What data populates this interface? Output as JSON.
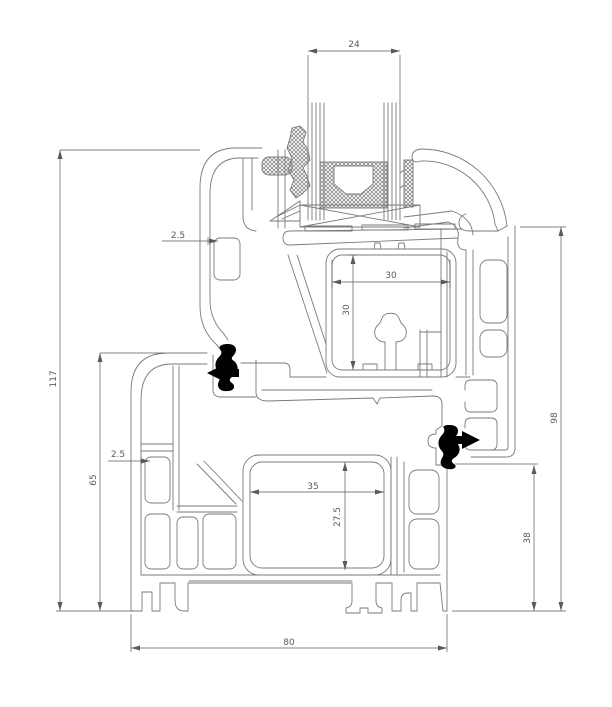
{
  "drawing": {
    "colors": {
      "line": "#7a7a7a",
      "dimension_text": "#5a5a5a",
      "seal": "#000000",
      "background": "#ffffff",
      "hatch": "#8a8a8a"
    },
    "dimensions": [
      {
        "name": "glazing-unit-width",
        "value": "24"
      },
      {
        "name": "sash-wall-thickness",
        "value": "2.5"
      },
      {
        "name": "reinforcement-chamber-width",
        "value": "30"
      },
      {
        "name": "reinforcement-chamber-height",
        "value": "30"
      },
      {
        "name": "overall-section-height",
        "value": "117"
      },
      {
        "name": "frame-profile-height",
        "value": "65"
      },
      {
        "name": "frame-wall-thickness",
        "value": "2.5"
      },
      {
        "name": "frame-chamber-width",
        "value": "35"
      },
      {
        "name": "frame-chamber-height",
        "value": "27.5"
      },
      {
        "name": "frame-rebate-height",
        "value": "38"
      },
      {
        "name": "sash-face-height",
        "value": "98"
      },
      {
        "name": "frame-profile-depth",
        "value": "80"
      }
    ]
  }
}
